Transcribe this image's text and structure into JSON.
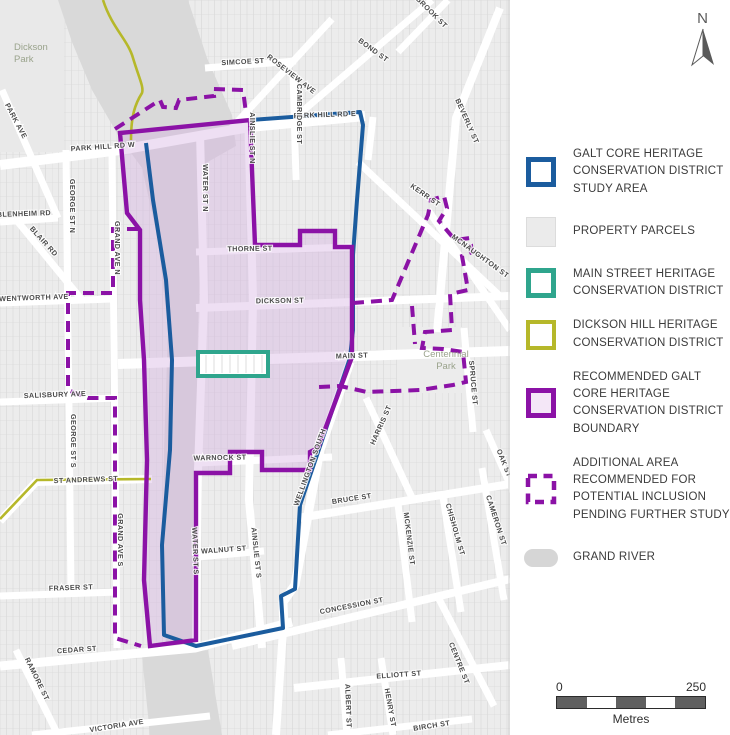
{
  "legend": {
    "items": [
      {
        "key": "study-area",
        "label": "GALT CORE HERITAGE CONSERVATION DISTRICT STUDY AREA",
        "color": "#1b5c9e"
      },
      {
        "key": "property-parcels",
        "label": "PROPERTY PARCELS",
        "color": "#ebebeb"
      },
      {
        "key": "main-street-hcd",
        "label": "MAIN STREET HERITAGE CONSERVATION DISTRICT",
        "color": "#2fa58d"
      },
      {
        "key": "dickson-hill-hcd",
        "label": "DICKSON HILL HERITAGE CONSERVATION DISTRICT",
        "color": "#b6b82a"
      },
      {
        "key": "recommended-boundary",
        "label": "RECOMMENDED GALT CORE HERITAGE CONSERVATION DISTRICT BOUNDARY",
        "color": "#8b12a6"
      },
      {
        "key": "additional-area",
        "label": "ADDITIONAL AREA RECOMMENDED FOR POTENTIAL INCLUSION PENDING FURTHER STUDY",
        "color": "#8b12a6"
      },
      {
        "key": "grand-river",
        "label": "GRAND RIVER",
        "color": "#d6d6d6"
      }
    ]
  },
  "north_arrow": {
    "label": "N"
  },
  "scale_bar": {
    "start": "0",
    "end": "250",
    "unit": "Metres"
  },
  "map": {
    "park_labels": [
      {
        "name": "dickson-park",
        "lines": [
          "Dickson",
          "Park"
        ],
        "x": 14,
        "y": 50,
        "anchor": "start"
      },
      {
        "name": "centennial-park",
        "lines": [
          "Centennial",
          "Park"
        ],
        "x": 446,
        "y": 357,
        "anchor": "middle"
      }
    ],
    "street_labels": [
      {
        "t": "PARK AVE",
        "x": 14,
        "y": 122,
        "r": 62
      },
      {
        "t": "PARK HILL RD W",
        "x": 103,
        "y": 149,
        "r": -4
      },
      {
        "t": "SIMCOE ST",
        "x": 243,
        "y": 64,
        "r": -3
      },
      {
        "t": "ROSEVIEW AVE",
        "x": 290,
        "y": 76,
        "r": 38
      },
      {
        "t": "BOND ST",
        "x": 372,
        "y": 52,
        "r": 36
      },
      {
        "t": "BROOK ST",
        "x": 430,
        "y": 14,
        "r": 45
      },
      {
        "t": "PARK HILL RD E",
        "x": 325,
        "y": 117,
        "r": -2
      },
      {
        "t": "CAMBRIDGE ST",
        "x": 297,
        "y": 114,
        "r": 90
      },
      {
        "t": "AINSLIE ST N",
        "x": 250,
        "y": 138,
        "r": 90
      },
      {
        "t": "KERR ST",
        "x": 424,
        "y": 197,
        "r": 35
      },
      {
        "t": "BEVERLY ST",
        "x": 465,
        "y": 122,
        "r": 66
      },
      {
        "t": "MCNAUGHTON ST",
        "x": 479,
        "y": 258,
        "r": 36
      },
      {
        "t": "WATER ST N",
        "x": 203,
        "y": 188,
        "r": 90
      },
      {
        "t": "THORNE ST",
        "x": 250,
        "y": 251,
        "r": -1
      },
      {
        "t": "DICKSON ST",
        "x": 280,
        "y": 303,
        "r": -1
      },
      {
        "t": "MAIN ST",
        "x": 352,
        "y": 358,
        "r": -2
      },
      {
        "t": "GRAND AVE N",
        "x": 115,
        "y": 248,
        "r": 90
      },
      {
        "t": "GEORGE ST N",
        "x": 70,
        "y": 206,
        "r": 90
      },
      {
        "t": "BLENHEIM RD",
        "x": 24,
        "y": 216,
        "r": -2
      },
      {
        "t": "BLAIR RD",
        "x": 42,
        "y": 243,
        "r": 48
      },
      {
        "t": "WENTWORTH AVE",
        "x": 34,
        "y": 300,
        "r": -2
      },
      {
        "t": "SALISBURY AVE",
        "x": 55,
        "y": 397,
        "r": -2
      },
      {
        "t": "GEORGE ST S",
        "x": 71,
        "y": 441,
        "r": 90
      },
      {
        "t": "ST ANDREWS ST",
        "x": 86,
        "y": 482,
        "r": -2
      },
      {
        "t": "GRAND AVE S",
        "x": 118,
        "y": 540,
        "r": 90
      },
      {
        "t": "WARNOCK ST",
        "x": 220,
        "y": 460,
        "r": -1
      },
      {
        "t": "WELLINGTON SOUTH",
        "x": 312,
        "y": 468,
        "r": -70
      },
      {
        "t": "HARRIS ST",
        "x": 383,
        "y": 426,
        "r": -66
      },
      {
        "t": "BRUCE ST",
        "x": 352,
        "y": 501,
        "r": -9
      },
      {
        "t": "CONCESSION ST",
        "x": 352,
        "y": 608,
        "r": -11
      },
      {
        "t": "WALNUT ST",
        "x": 224,
        "y": 552,
        "r": -4
      },
      {
        "t": "AINSLIE ST S",
        "x": 254,
        "y": 553,
        "r": 84
      },
      {
        "t": "WATER ST S",
        "x": 193,
        "y": 551,
        "r": 88
      },
      {
        "t": "FRASER ST",
        "x": 71,
        "y": 590,
        "r": -2
      },
      {
        "t": "CEDAR ST",
        "x": 77,
        "y": 652,
        "r": -4
      },
      {
        "t": "RAMORE ST",
        "x": 35,
        "y": 680,
        "r": 64
      },
      {
        "t": "VICTORIA AVE",
        "x": 117,
        "y": 728,
        "r": -9
      },
      {
        "t": "ELLIOTT ST",
        "x": 399,
        "y": 677,
        "r": -4
      },
      {
        "t": "CENTRE ST",
        "x": 457,
        "y": 664,
        "r": 68
      },
      {
        "t": "ALBERT ST",
        "x": 346,
        "y": 706,
        "r": 88
      },
      {
        "t": "HENRY ST",
        "x": 388,
        "y": 708,
        "r": 80
      },
      {
        "t": "BIRCH ST",
        "x": 432,
        "y": 728,
        "r": -9
      },
      {
        "t": "MCKENZIE ST",
        "x": 407,
        "y": 539,
        "r": 83
      },
      {
        "t": "CHISHOLM ST",
        "x": 453,
        "y": 530,
        "r": 74
      },
      {
        "t": "CAMERON ST",
        "x": 494,
        "y": 521,
        "r": 72
      },
      {
        "t": "OAK ST",
        "x": 502,
        "y": 464,
        "r": 68
      },
      {
        "t": "SPRUCE ST",
        "x": 471,
        "y": 383,
        "r": 85
      }
    ]
  },
  "colors": {
    "study_area_blue": "#1b5c9e",
    "recommended_purple": "#8b12a6",
    "recommended_fill_pink": "#eee1f1",
    "main_street_teal": "#2fa58d",
    "dickson_hill_olive": "#b6b82a",
    "parcel_gray": "#ececec",
    "river_gray": "#d9d9d9"
  }
}
